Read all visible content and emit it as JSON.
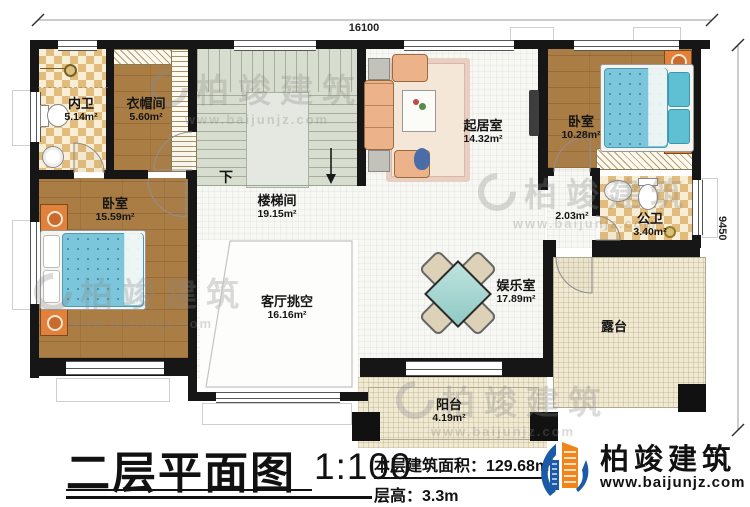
{
  "title_block": {
    "title": "二层平面图",
    "scale": "1:100",
    "floor_area": "本层建筑面积：129.68m²",
    "floor_height": "层高：3.3m"
  },
  "brand": {
    "name": "柏竣建筑",
    "website": "www.baijunjz.com"
  },
  "watermark": {
    "name": "柏竣建筑",
    "website": "www.baijunjz.com"
  },
  "dimensions": {
    "width_mm": "16100",
    "height_mm": "9450"
  },
  "stairs": {
    "down_label": "下"
  },
  "rooms": [
    {
      "name": "内卫",
      "area": "5.14m²"
    },
    {
      "name": "衣帽间",
      "area": "5.60m²"
    },
    {
      "name": "卧室",
      "area": "15.59m²"
    },
    {
      "name": "楼梯间",
      "area": "19.15m²"
    },
    {
      "name": "起居室",
      "area": "14.32m²"
    },
    {
      "name": "卧室",
      "area": "10.28m²"
    },
    {
      "name": "公卫",
      "area": "3.40m²"
    },
    {
      "name": "",
      "area": "2.03m²"
    },
    {
      "name": "客厅挑空",
      "area": "16.16m²"
    },
    {
      "name": "娱乐室",
      "area": "17.89m²"
    },
    {
      "name": "露台",
      "area": ""
    },
    {
      "name": "阳台",
      "area": "4.19m²"
    }
  ]
}
